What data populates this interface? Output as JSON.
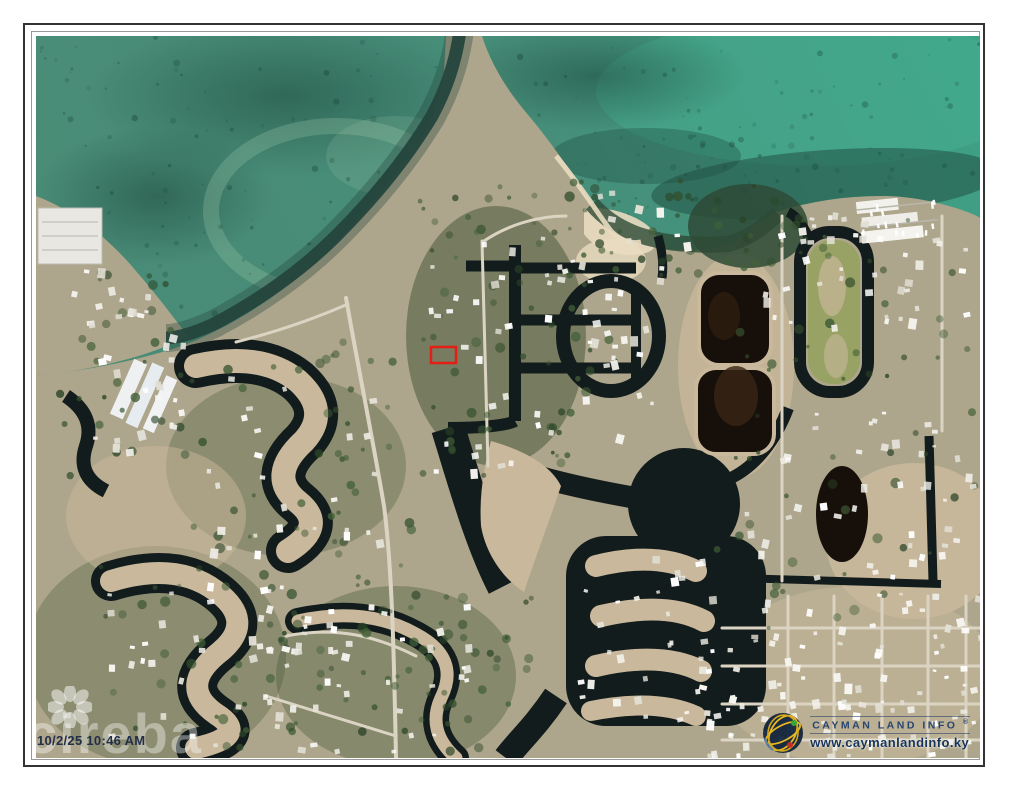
{
  "frame": {
    "page_bg": "#ffffff",
    "outer_border": "#333333",
    "inner_border": "#999999"
  },
  "overlays": {
    "timestamp": "10/2/25 10:46 AM",
    "watermark": {
      "brand": "cireba"
    },
    "provider": {
      "name": "CAYMAN LAND INFO",
      "registered_mark": "®",
      "url": "www.caymanlandinfo.ky"
    }
  },
  "map": {
    "kind": "satellite-aerial-photo",
    "description": "Aerial photograph of a coastal canal-front residential development; subject parcel outlined in red",
    "highlight_parcel": {
      "x": 395,
      "y": 311,
      "width": 25,
      "height": 16,
      "stroke_color": "#e41d15",
      "stroke_width": 2.5
    },
    "palette": {
      "sea": "#4a8b76",
      "sea_bright": "#3ea287",
      "sea_dark": "#1e4a3e",
      "shallow": "#9fc9ac",
      "land": "#aea68c",
      "cleared": "#c9b89b",
      "veg": "#3f5233",
      "grass": "#97a264",
      "canal": "#131c1c",
      "channel": "#25443c",
      "mangrove": "#2e4a36",
      "road": "#dbd4c3",
      "roof": "#f4f3ee",
      "pond": "#17100a",
      "beach": "#e9dcc0"
    }
  }
}
